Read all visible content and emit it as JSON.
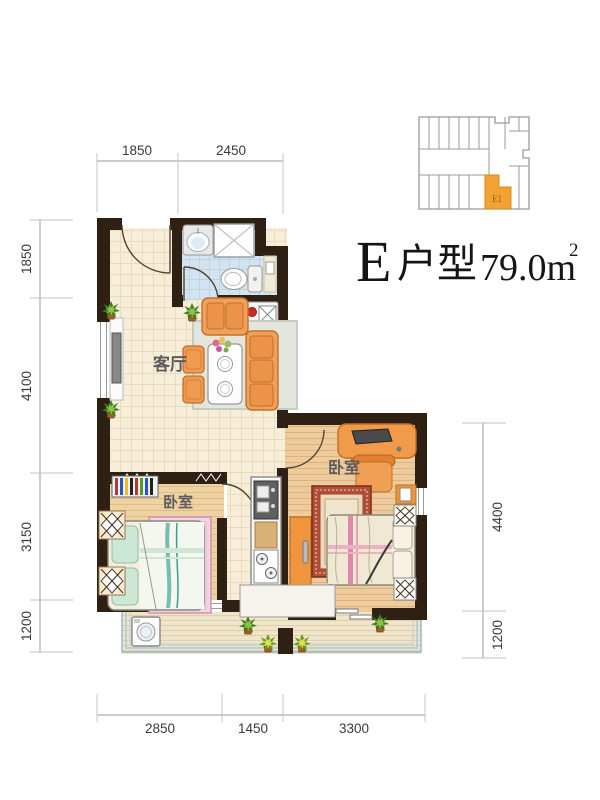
{
  "title": {
    "series_letter": "E",
    "type_label": "户型",
    "area_value": "79.0m",
    "area_superscript": "2"
  },
  "key_plan": {
    "unit_label": "E1",
    "highlight_color": "#f2a133"
  },
  "room_labels": {
    "living_room": "客厅",
    "bedroom_left": "卧室",
    "bedroom_right": "卧室"
  },
  "dimensions": {
    "top": [
      "1850",
      "2450"
    ],
    "left": [
      "1850",
      "4100",
      "3150",
      "1200"
    ],
    "right": [
      "4400",
      "1200"
    ],
    "bottom": [
      "2850",
      "1450",
      "3300"
    ]
  },
  "colors": {
    "wall": "#2e2013",
    "unit_highlight": "#f2a133",
    "furniture_orange": "#f0a057",
    "bathroom_tile": "#d3e3f0",
    "living_tile": "#f6eed8",
    "bedroom_wood": "#eed2a2",
    "balcony_rail": "#a6c6da",
    "dimension_text": "#3a3a3a"
  }
}
